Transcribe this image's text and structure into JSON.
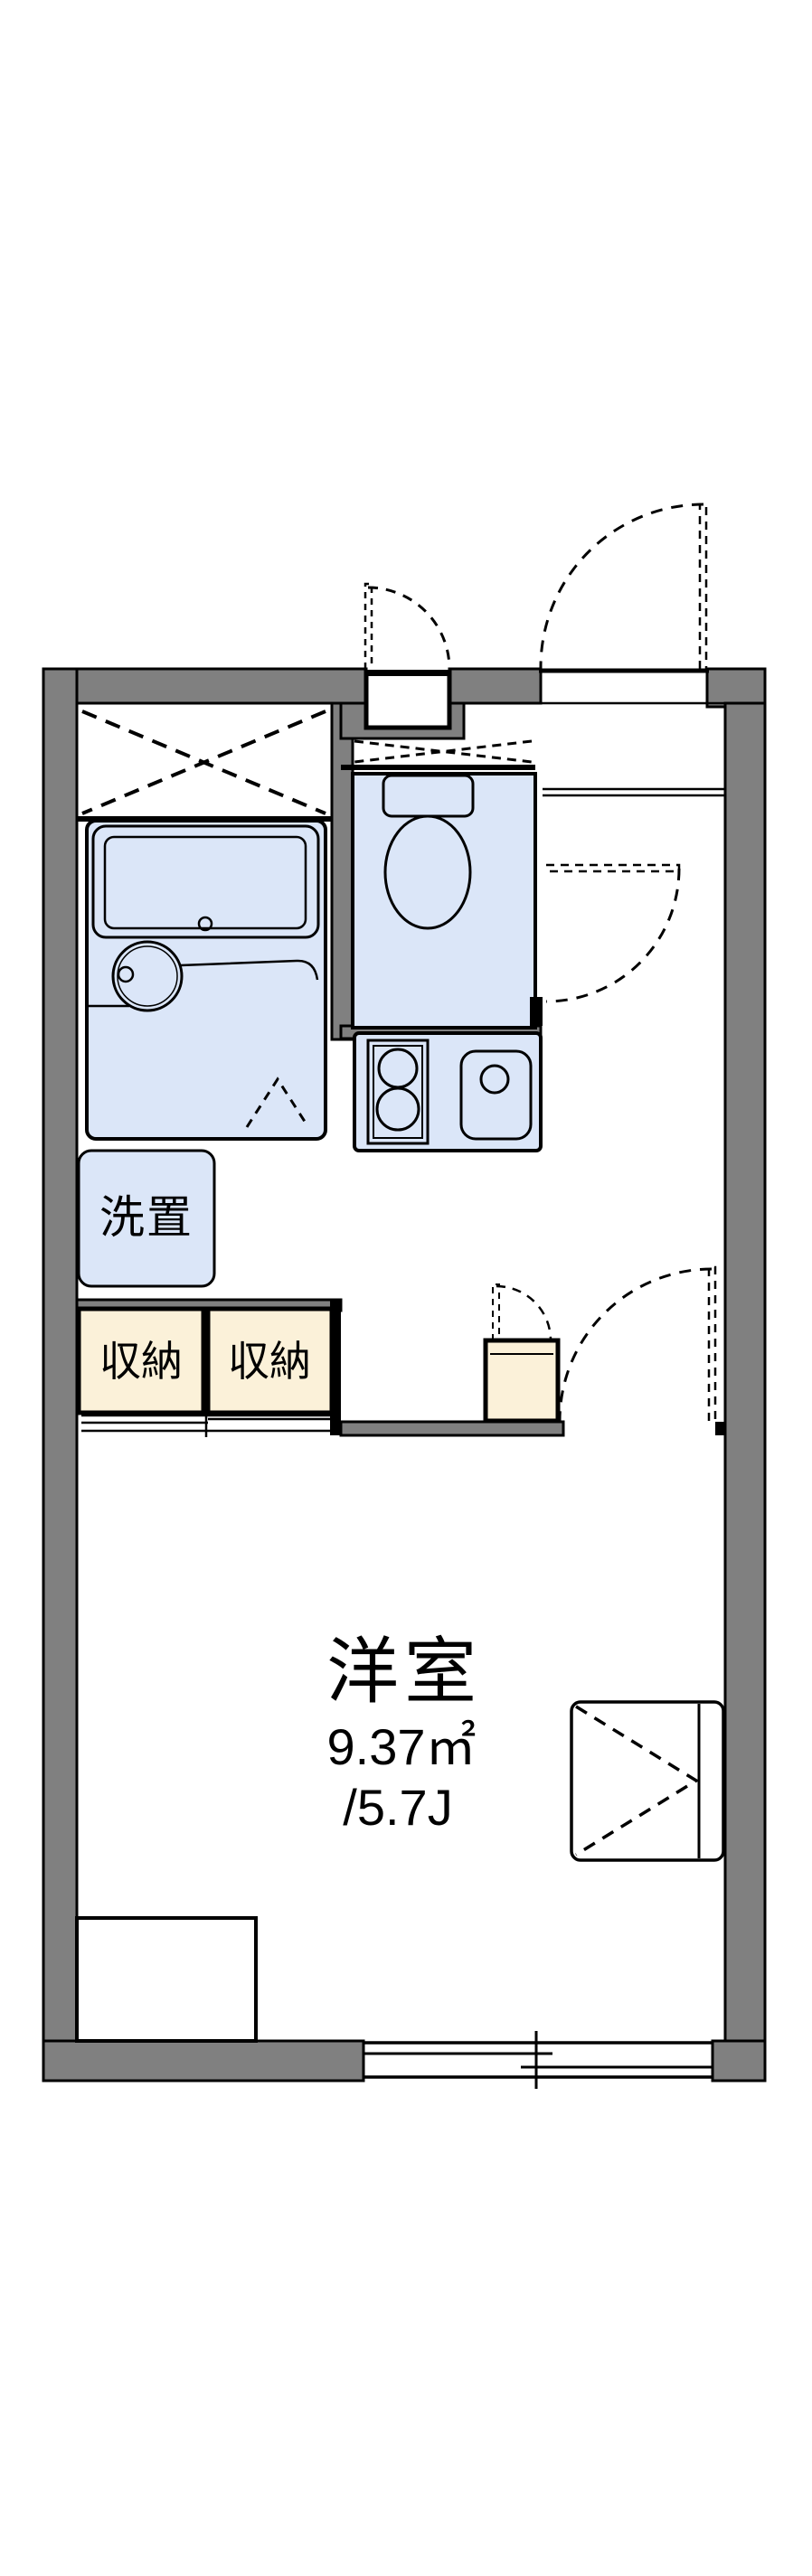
{
  "plan": {
    "room_label": "洋室",
    "room_area": "9.37㎡",
    "room_tatami": "/5.7J",
    "washer_label": "洗置",
    "storage_left_label": "収納",
    "storage_right_label": "収納"
  },
  "colors": {
    "wall": "#808080",
    "line": "#000000",
    "fixture": "#dbe6f8",
    "storage": "#fbf1d9",
    "bg": "#ffffff"
  }
}
